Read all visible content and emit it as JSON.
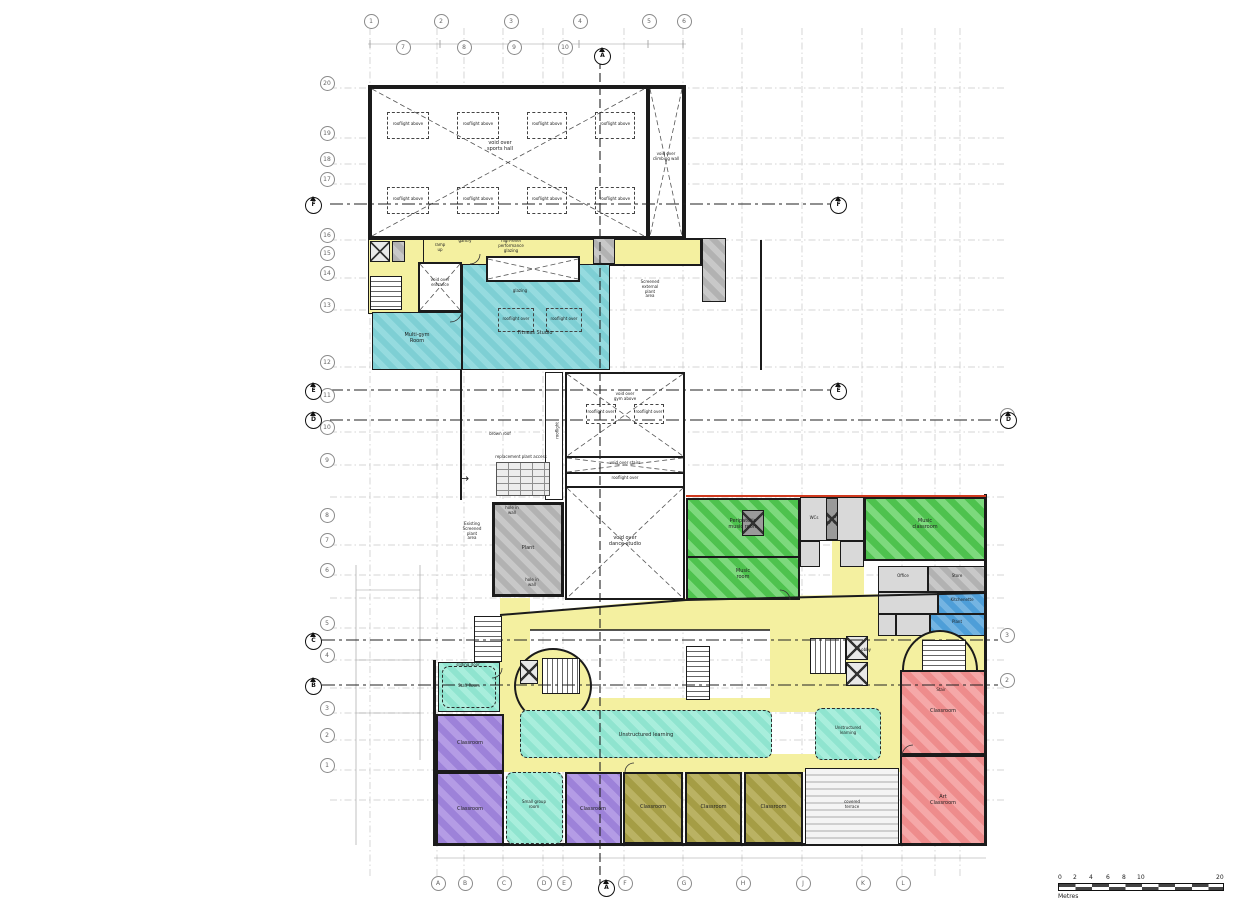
{
  "drawing": {
    "kind": "architectural floor plan",
    "scale_bar": {
      "ticks": [
        "0",
        "2",
        "4",
        "6",
        "8",
        "10",
        "20"
      ],
      "unit": "Metres"
    }
  },
  "grid": {
    "bottom": [
      "A",
      "B",
      "C",
      "D",
      "E",
      "F",
      "G",
      "H",
      "J",
      "K",
      "L"
    ],
    "left": [
      "20",
      "19",
      "18",
      "17",
      "16",
      "15",
      "14",
      "13",
      "12",
      "11",
      "10",
      "9",
      "8",
      "7",
      "6",
      "5",
      "4",
      "3",
      "2",
      "1"
    ],
    "top": [
      "1",
      "2",
      "3",
      "4",
      "5",
      "6"
    ],
    "top2": [
      "7",
      "8",
      "9",
      "10"
    ],
    "right": [
      "4",
      "3",
      "2"
    ]
  },
  "section_markers": [
    "A",
    "A",
    "F",
    "F",
    "E",
    "E",
    "D",
    "D",
    "C",
    "B"
  ],
  "annotations": {
    "rooflight_above": "rooflight above",
    "void_sports_hall": "void over\nsports hall",
    "void_climbing_wall": "void over\nclimbing wall",
    "gantry": "gantry",
    "high_level": "high-level\nperformance\nglazing",
    "ramp_up": "ramp\nup",
    "void_entrance": "void over\nentrance",
    "glazing": "glazing",
    "rooflight_over": "rooflight over",
    "screened_plant": "Screened\nexternal\nplant\narea",
    "brown_roof": "brown roof",
    "replacement_access": "replacement plant access",
    "rooflight_rot": "rooflight",
    "void_gym_above": "void over\ngym above",
    "void_stairs": "void over stairs",
    "void_dance": "void over\ndance studio",
    "existing_plant": "Existing\nScreened\nplant\narea",
    "hole_in_wall": "hole in\nwall",
    "sliding_door": "sliding door"
  },
  "rooms": {
    "multi_gym": "Multi-gym\nRoom",
    "fitness_studio": "Fitness Studio",
    "plant_room": "Plant",
    "staff_room": "Staff Room",
    "classroom": "Classroom",
    "art_classroom": "Art\nClassroom",
    "small_group": "Small group\nroom",
    "unstructured_long": "Unstructured learning",
    "unstructured_small": "Unstructured\nlearning",
    "peripatetic": "Peripatetic\nmusic room",
    "music_room": "Music\nroom",
    "music_classroom": "Music\nclassroom",
    "wcs": "WCs",
    "office": "Office",
    "store": "Store",
    "kitchenette": "Kitchenette",
    "plant_small": "Plant",
    "lobby": "Lobby",
    "stair": "Stair",
    "covered_terrace": "covered\nterrace"
  }
}
